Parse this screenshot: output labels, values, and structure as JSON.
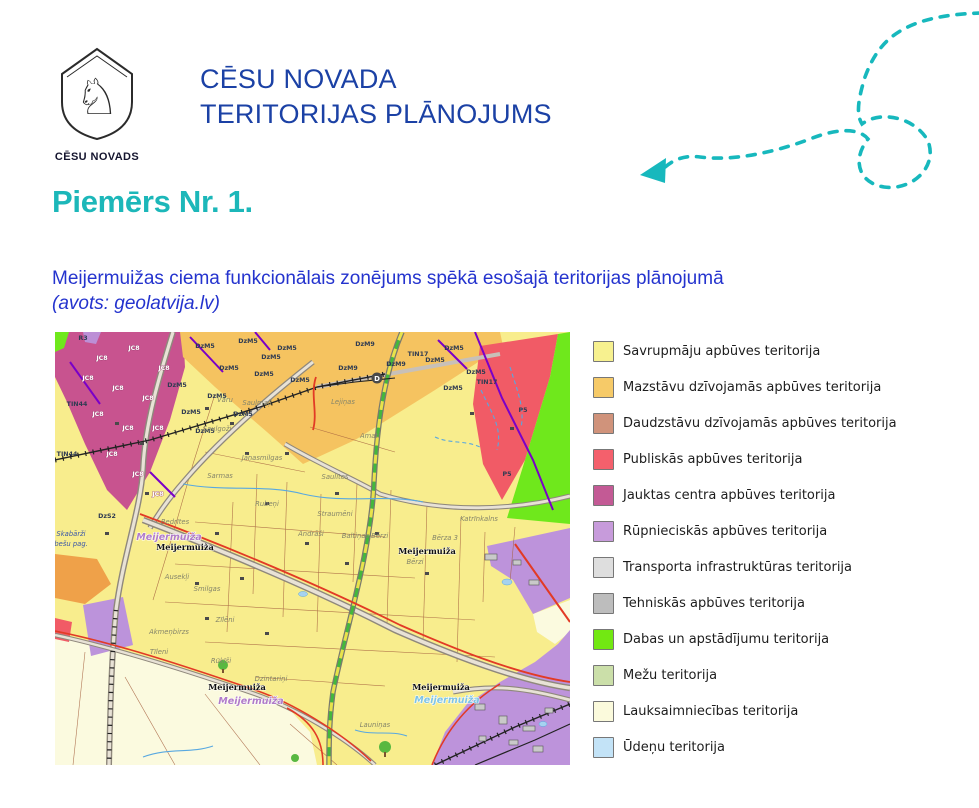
{
  "header": {
    "logo_caption": "CĒSU NOVADS",
    "title_line1": "CĒSU NOVADA",
    "title_line2": "TERITORIJAS PLĀNOJUMS"
  },
  "section": {
    "heading": "Piemērs Nr. 1."
  },
  "subtitle": {
    "line1": "Meijermuižas ciema funkcionālais zonējums spēkā esošajā teritorijas plānojumā",
    "line2": "(avots: geolatvija.lv)"
  },
  "colors": {
    "title_blue": "#1B41A5",
    "subtitle_blue": "#2433CE",
    "accent_teal": "#1CB7B9",
    "map_yellow": "#F8ED8D",
    "map_magenta": "#C8538F",
    "map_orange": "#F5C360",
    "map_red": "#F15B66",
    "map_green": "#6FE81C",
    "map_purple": "#BD93DB",
    "map_cream": "#FBFADF"
  },
  "legend": {
    "items": [
      {
        "label": "Savrupmāju apbūves teritorija",
        "color": "#F7F18F"
      },
      {
        "label": "Mazstāvu dzīvojamās apbūves teritorija",
        "color": "#F6CA68"
      },
      {
        "label": "Daudzstāvu dzīvojamās apbūves teritorija",
        "color": "#D0937B"
      },
      {
        "label": "Publiskās apbūves teritorija",
        "color": "#F4606C"
      },
      {
        "label": "Jauktas centra apbūves teritorija",
        "color": "#C35A95"
      },
      {
        "label": "Rūpnieciskās apbūves teritorija",
        "color": "#C79BDB"
      },
      {
        "label": "Transporta infrastruktūras teritorija",
        "color": "#DEDEDE"
      },
      {
        "label": "Tehniskās apbūves teritorija",
        "color": "#BDBDBD"
      },
      {
        "label": "Dabas un apstādījumu teritorija",
        "color": "#72E812"
      },
      {
        "label": "Mežu teritorija",
        "color": "#CBDFA9"
      },
      {
        "label": "Lauksaimniecības teritorija",
        "color": "#FBFADC"
      },
      {
        "label": "Ūdeņu teritorija",
        "color": "#C3E3F7"
      }
    ]
  },
  "map": {
    "zone_codes": [
      {
        "t": "DzM5",
        "x": 150,
        "y": 16
      },
      {
        "t": "DzM5",
        "x": 193,
        "y": 11
      },
      {
        "t": "DzM5",
        "x": 232,
        "y": 18
      },
      {
        "t": "DzM5",
        "x": 174,
        "y": 38
      },
      {
        "t": "DzM5",
        "x": 209,
        "y": 44
      },
      {
        "t": "DzM5",
        "x": 245,
        "y": 50
      },
      {
        "t": "DzM5",
        "x": 162,
        "y": 66
      },
      {
        "t": "DzM5",
        "x": 136,
        "y": 82
      },
      {
        "t": "DzM5",
        "x": 188,
        "y": 84
      },
      {
        "t": "DzM5",
        "x": 150,
        "y": 101
      },
      {
        "t": "DzM5",
        "x": 216,
        "y": 27
      },
      {
        "t": "DzM5",
        "x": 122,
        "y": 55
      },
      {
        "t": "DzM5",
        "x": 399,
        "y": 18
      },
      {
        "t": "DzM5",
        "x": 421,
        "y": 42
      },
      {
        "t": "DzM5",
        "x": 380,
        "y": 30
      },
      {
        "t": "DzM5",
        "x": 398,
        "y": 58
      },
      {
        "t": "DzM9",
        "x": 310,
        "y": 14
      },
      {
        "t": "DzM9",
        "x": 341,
        "y": 34
      },
      {
        "t": "DzM9",
        "x": 293,
        "y": 38
      },
      {
        "t": "TIN17",
        "x": 363,
        "y": 24
      },
      {
        "t": "TIN17",
        "x": 432,
        "y": 52
      },
      {
        "t": "TIN44",
        "x": 22,
        "y": 74
      },
      {
        "t": "TIN44",
        "x": 12,
        "y": 124
      },
      {
        "t": "P5",
        "x": 468,
        "y": 80
      },
      {
        "t": "P5",
        "x": 452,
        "y": 144
      },
      {
        "t": "R3",
        "x": 28,
        "y": 8
      },
      {
        "t": "DzS2",
        "x": 52,
        "y": 186
      }
    ],
    "zone_codes_light": [
      {
        "t": "JC8",
        "x": 47,
        "y": 28
      },
      {
        "t": "JC8",
        "x": 79,
        "y": 18
      },
      {
        "t": "JC8",
        "x": 109,
        "y": 38
      },
      {
        "t": "JC8",
        "x": 63,
        "y": 58
      },
      {
        "t": "JC8",
        "x": 93,
        "y": 68
      },
      {
        "t": "JC8",
        "x": 43,
        "y": 84
      },
      {
        "t": "JC8",
        "x": 73,
        "y": 98
      },
      {
        "t": "JC8",
        "x": 103,
        "y": 98
      },
      {
        "t": "JC8",
        "x": 57,
        "y": 124
      },
      {
        "t": "JC8",
        "x": 83,
        "y": 144
      },
      {
        "t": "JC8",
        "x": 103,
        "y": 164
      },
      {
        "t": "JC8",
        "x": 33,
        "y": 48
      }
    ],
    "place_labels": [
      {
        "t": "Vāru",
        "x": 170,
        "y": 70
      },
      {
        "t": "Saulmaļi",
        "x": 202,
        "y": 73
      },
      {
        "t": "Saulgoži",
        "x": 162,
        "y": 99
      },
      {
        "t": "Jāņasmilgas",
        "x": 207,
        "y": 128
      },
      {
        "t": "Sarmas",
        "x": 165,
        "y": 146
      },
      {
        "t": "Rubeņi",
        "x": 212,
        "y": 174
      },
      {
        "t": "Straumēni",
        "x": 280,
        "y": 184
      },
      {
        "t": "Saulītes",
        "x": 280,
        "y": 147
      },
      {
        "t": "Amati",
        "x": 315,
        "y": 106
      },
      {
        "t": "Lejiņas",
        "x": 288,
        "y": 72
      },
      {
        "t": "Bedrītes",
        "x": 120,
        "y": 192
      },
      {
        "t": "Katrīnkalns",
        "x": 424,
        "y": 189
      },
      {
        "t": "Bērza 3",
        "x": 390,
        "y": 208
      },
      {
        "t": "Baltiņas Bērzi",
        "x": 310,
        "y": 206
      },
      {
        "t": "Bērzi",
        "x": 360,
        "y": 232
      },
      {
        "t": "Akmeņbirzs",
        "x": 114,
        "y": 302
      },
      {
        "t": "Tīleni",
        "x": 104,
        "y": 322
      },
      {
        "t": "Rūķīši",
        "x": 166,
        "y": 331
      },
      {
        "t": "Dzintariņi",
        "x": 216,
        "y": 349
      },
      {
        "t": "Smilgas",
        "x": 152,
        "y": 259
      },
      {
        "t": "Ausekļi",
        "x": 122,
        "y": 247
      },
      {
        "t": "Launiņas",
        "x": 320,
        "y": 395
      },
      {
        "t": "Andrāši",
        "x": 256,
        "y": 204
      },
      {
        "t": "Zīlēni",
        "x": 170,
        "y": 290
      }
    ],
    "place_labels_blue": [
      {
        "t": "Skabārži",
        "x": 16,
        "y": 204
      },
      {
        "t": "abešu pag.",
        "x": 14,
        "y": 214
      }
    ],
    "settlement_labels": [
      {
        "t": "Meijermuiža",
        "x": 130,
        "y": 218
      },
      {
        "t": "Meijermuiža",
        "x": 372,
        "y": 222
      },
      {
        "t": "Meijermuiža",
        "x": 182,
        "y": 358
      },
      {
        "t": "Meijermuiža",
        "x": 386,
        "y": 358
      }
    ],
    "settlement_halo_labels": [
      {
        "t": "Meijermuiža",
        "x": 114,
        "y": 208,
        "c": "#B07CC8"
      },
      {
        "t": "Meijermuiža",
        "x": 196,
        "y": 372,
        "c": "#B07CC8"
      },
      {
        "t": "Meijermuiža",
        "x": 392,
        "y": 371,
        "c": "#7FC4E4"
      }
    ],
    "road_marker": "D"
  }
}
